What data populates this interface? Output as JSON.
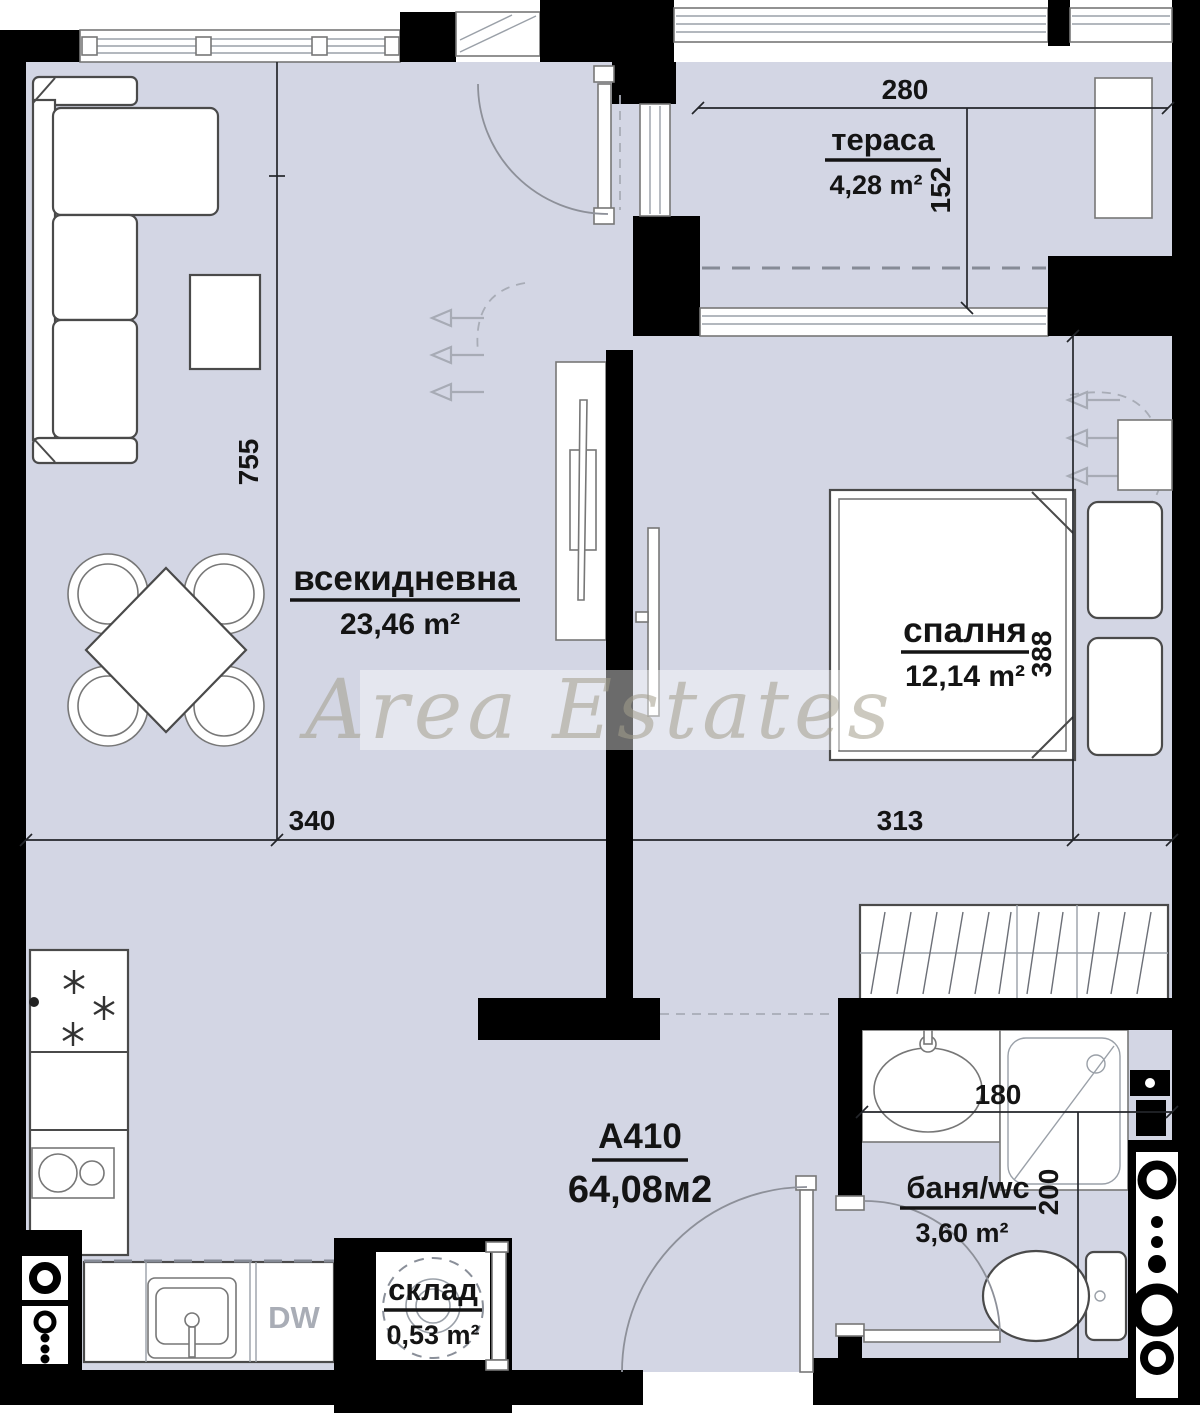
{
  "watermark": {
    "text": "Area Estates"
  },
  "apartment": {
    "id": "A410",
    "total_area": "64,08м2"
  },
  "rooms": [
    {
      "name": "тераса",
      "area": "4,28 m²"
    },
    {
      "name": "всекидневна",
      "area": "23,46 m²"
    },
    {
      "name": "спалня",
      "area": "12,14 m²"
    },
    {
      "name": "баня/wc",
      "area": "3,60 m²"
    },
    {
      "name": "склад",
      "area": "0,53 m²"
    }
  ],
  "dimensions": {
    "terrace_width": "280",
    "terrace_depth": "152",
    "living_height": "755",
    "living_width": "340",
    "bedroom_width": "313",
    "bedroom_depth": "388",
    "bath_width": "180",
    "bath_depth": "200"
  },
  "appliances": {
    "dishwasher": "DW"
  },
  "colors": {
    "floor": "#d3d6e4",
    "wall": "#000000",
    "outline": "#4a4a4a",
    "dim_text": "#141414",
    "watermark": "#a39e8c"
  }
}
